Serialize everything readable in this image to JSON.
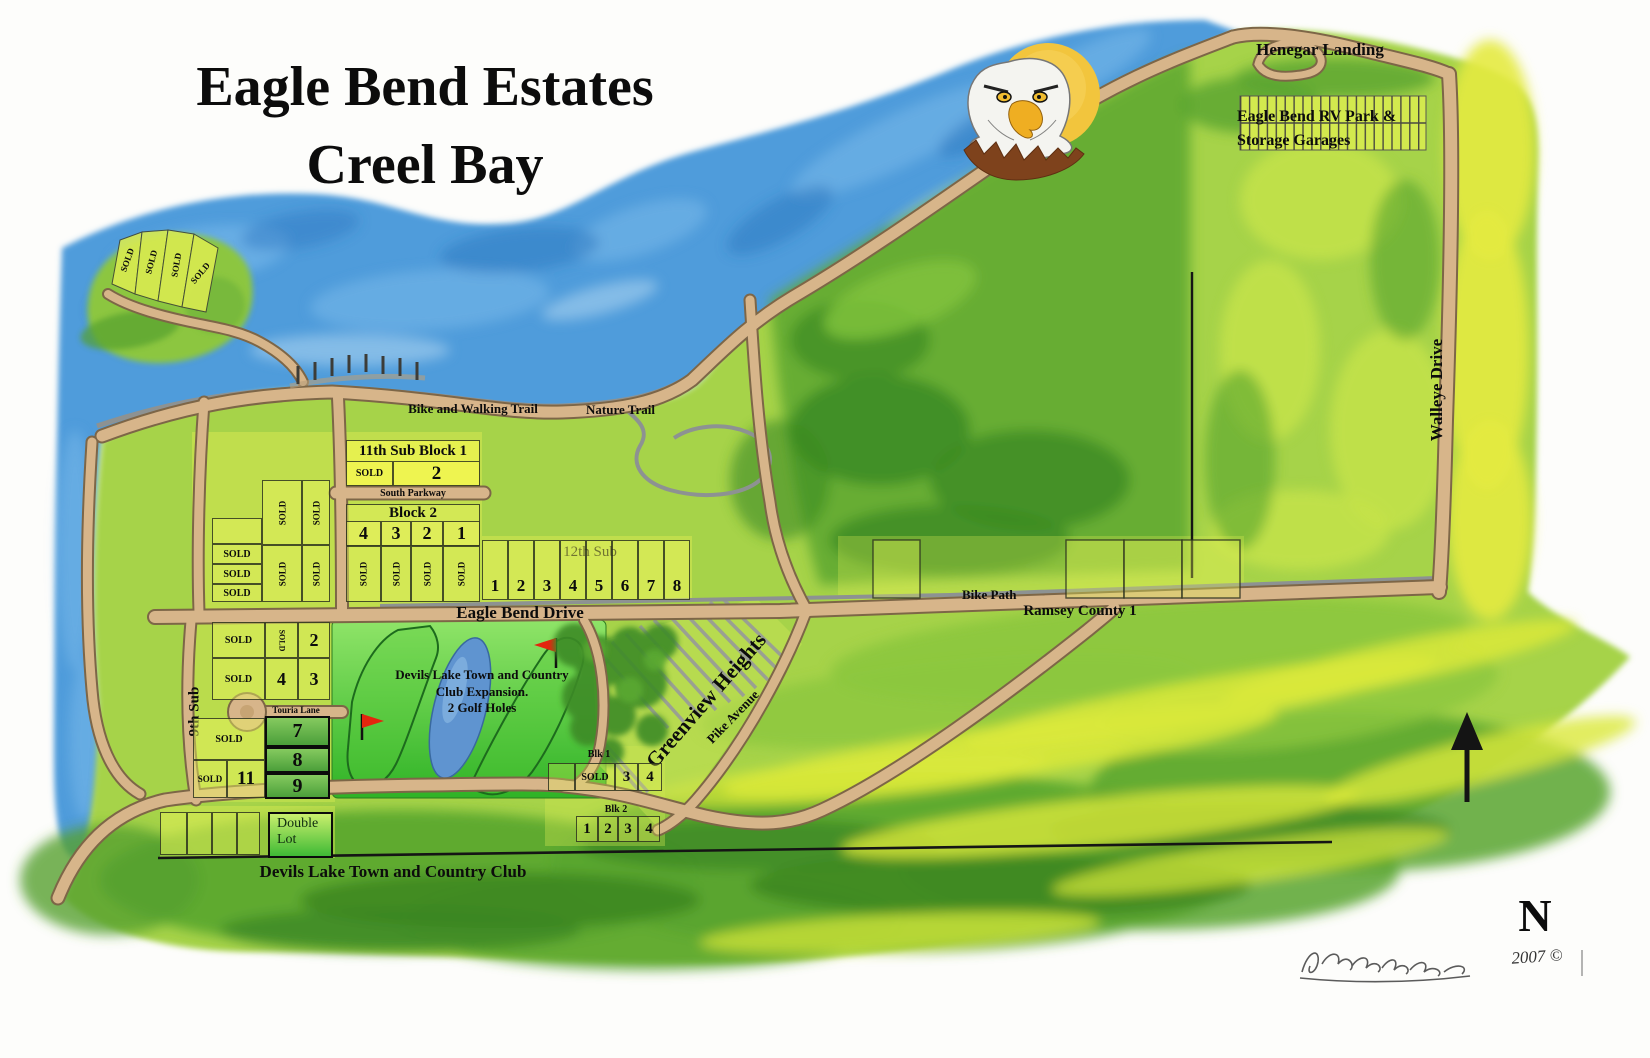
{
  "title": {
    "line1": "Eagle Bend Estates",
    "line2": "Creel Bay"
  },
  "north_arrow": {
    "label": "N"
  },
  "signature": {
    "year": "2007 ©"
  },
  "colors": {
    "water": "#4f9cdb",
    "land_green": "#a6d348",
    "road_tan": "#d7b58a",
    "golf_green": "#45bf2e",
    "lot_yellow": "#e9f45e",
    "sun_yellow": "#f2c53d",
    "flag_red": "#e4250e",
    "sold_lot_green": "#69b14e"
  },
  "roads": {
    "bike_walking_trail": "Bike and Walking Trail",
    "nature_trail": "Nature Trail",
    "south_parkway": "South Parkway",
    "eagle_bend_drive": "Eagle Bend Drive",
    "bike_path": "Bike Path",
    "ramsey_county_1": "Ramsey County 1",
    "touria_lane": "Touria Lane",
    "pike_avenue": "Pike Avenue",
    "walleye_drive": "Walleye Drive",
    "henegar_landing": "Henegar Landing"
  },
  "areas": {
    "rv_park": {
      "line1": "Eagle Bend RV Park &",
      "line2": "Storage Garages"
    },
    "greenview_heights": "Greenview Heights",
    "ninth_sub": "9th Sub",
    "country_club": "Devils Lake Town and Country Club",
    "golf_expansion": {
      "line1": "Devils Lake Town and Country",
      "line2": "Club Expansion.",
      "line3": "2 Golf Holes"
    },
    "double_lot": {
      "line1": "Double",
      "line2": "Lot"
    }
  },
  "subdivisions": {
    "peninsula": {
      "lots": [
        "SOLD",
        "SOLD",
        "SOLD",
        "SOLD"
      ]
    },
    "sub11": {
      "title": "11th Sub Block 1",
      "lots": [
        "SOLD",
        "2"
      ]
    },
    "block2": {
      "title": "Block 2",
      "lots": [
        "4",
        "3",
        "2",
        "1"
      ],
      "sold_row": [
        "SOLD",
        "SOLD",
        "SOLD",
        "SOLD"
      ]
    },
    "west_block": {
      "h_lots": [
        "SOLD",
        "SOLD",
        "SOLD"
      ],
      "v_lots": [
        "SOLD",
        "SOLD",
        "SOLD",
        "SOLD"
      ]
    },
    "sub12": {
      "title": "12th Sub",
      "lots": [
        "1",
        "2",
        "3",
        "4",
        "5",
        "6",
        "7",
        "8"
      ]
    },
    "mid_block": {
      "row1": [
        "SOLD",
        "SOLD",
        "2"
      ],
      "row2": [
        "SOLD",
        "4",
        "3"
      ]
    },
    "south_block": {
      "sold_top": "SOLD",
      "lot7": "7",
      "lot8": "8",
      "lot9": "9",
      "sold_bottom": "SOLD",
      "lot11": "11"
    },
    "blk1": {
      "title": "Blk 1",
      "lots": [
        "SOLD",
        "3",
        "4"
      ]
    },
    "blk2": {
      "title": "Blk 2",
      "lots": [
        "1",
        "2",
        "3",
        "4"
      ]
    }
  }
}
